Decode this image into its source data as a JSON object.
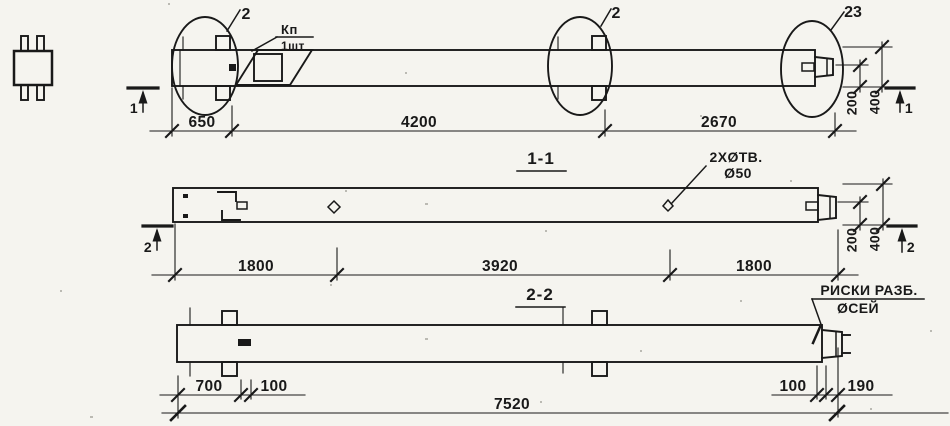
{
  "palette": {
    "paper": "#f5f4ef",
    "ink": "#191919"
  },
  "plan_view": {
    "detail_callout_left": "2",
    "detail_callout_mid": "2",
    "detail_callout_right": "23",
    "flag_note": {
      "top": "Кп",
      "bottom": "1шт"
    },
    "section_cut_left": "1",
    "section_cut_right": "1",
    "dims": {
      "seg1": "650",
      "seg2": "4200",
      "seg3": "2670"
    },
    "vdims": {
      "inner": "200",
      "outer": "400"
    }
  },
  "section_1_1": {
    "title": "1-1",
    "holes_note": {
      "line1": "2ХØТВ.",
      "line2": "Ø50"
    },
    "section_cut_left": "2",
    "section_cut_right": "2",
    "dims": {
      "seg1": "1800",
      "seg2": "3920",
      "seg3": "1800"
    },
    "vdims": {
      "inner": "200",
      "outer": "400"
    }
  },
  "section_2_2": {
    "title": "2-2",
    "axes_note": {
      "line1": "РИСКИ РАЗБ.",
      "line2": "ØСЕЙ"
    },
    "dims": {
      "seg1": "700",
      "seg2": "100",
      "seg3": "100",
      "seg4": "190",
      "overall": "7520"
    }
  }
}
